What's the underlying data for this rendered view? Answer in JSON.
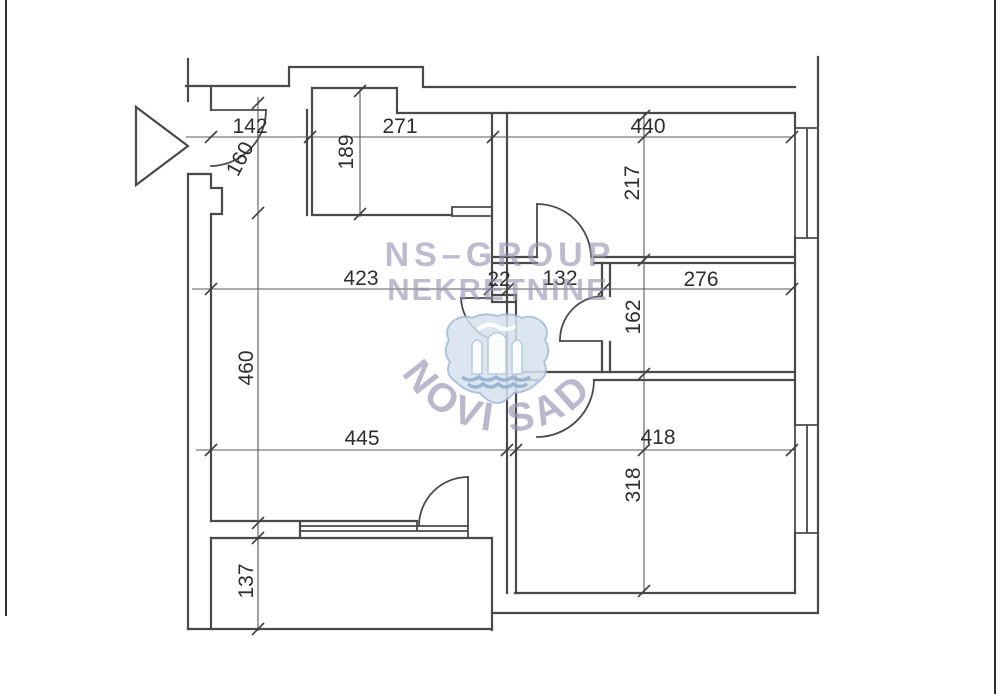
{
  "watermark": {
    "line1": "NS–GROUP",
    "line2": "NEKRETNINE",
    "arc_text": "NOVI SAD"
  },
  "dimensions": [
    {
      "name": "entry-width",
      "label": "142"
    },
    {
      "name": "kitchen-niche-width",
      "label": "271"
    },
    {
      "name": "top-room-width",
      "label": "440"
    },
    {
      "name": "entry-depth",
      "label": "160"
    },
    {
      "name": "kitchen-niche-depth",
      "label": "189"
    },
    {
      "name": "top-room-depth",
      "label": "217"
    },
    {
      "name": "hall-width",
      "label": "423"
    },
    {
      "name": "wall-thickness",
      "label": "22"
    },
    {
      "name": "bathroom-width",
      "label": "132"
    },
    {
      "name": "middle-room-width",
      "label": "276"
    },
    {
      "name": "middle-room-depth",
      "label": "162"
    },
    {
      "name": "living-room-depth",
      "label": "460"
    },
    {
      "name": "living-room-width",
      "label": "445"
    },
    {
      "name": "bottom-room-width",
      "label": "418"
    },
    {
      "name": "bottom-room-depth",
      "label": "318"
    },
    {
      "name": "balcony-depth",
      "label": "137"
    }
  ],
  "colors": {
    "wall_line": "#4a4a4a",
    "dimension_text": "#2e2e2e",
    "watermark_text": "#9890b0",
    "crest_fill": "#d6e2ee",
    "crest_outline": "#9fbad4"
  }
}
